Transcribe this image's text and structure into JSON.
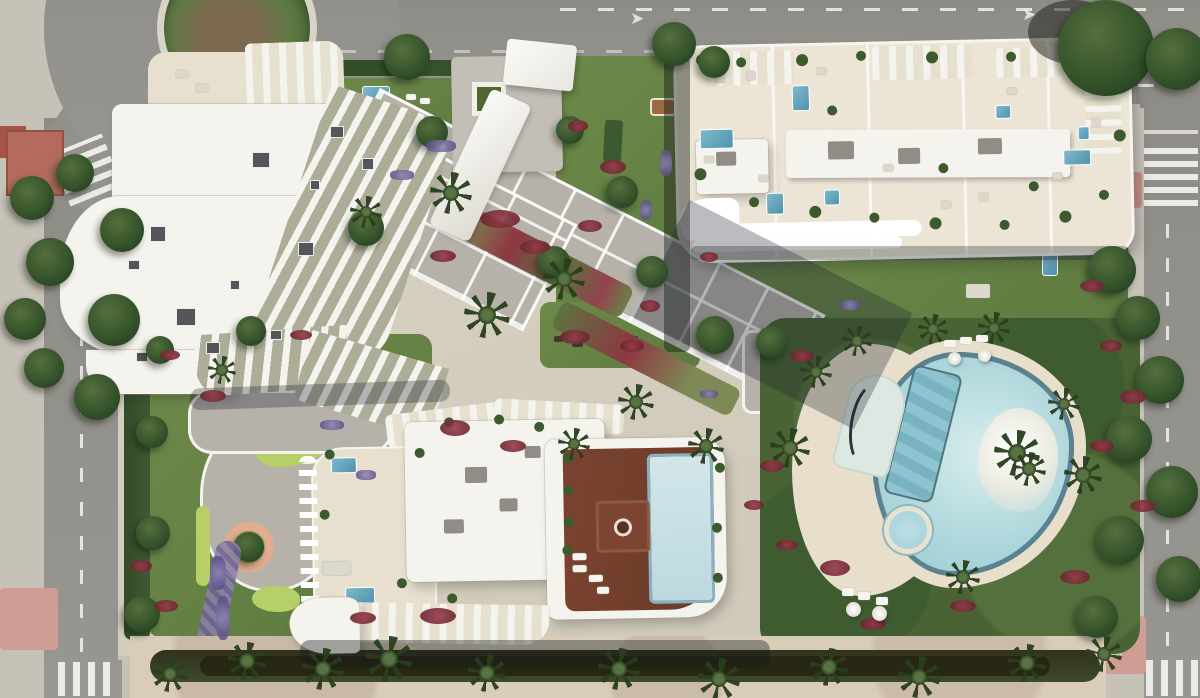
{
  "meta": {
    "title": "Aerial render of a residential resort block",
    "description": "Top-down architectural rendering: three white apartment buildings with roof terraces and plunge pools, central landscaped gardens with mini-golf, a lagoon-style pool with palm island, perimeter roads with a roundabout, zebra crossings and a beach promenade along the bottom.",
    "width": 1200,
    "height": 698
  },
  "palette": {
    "asphalt": "#8e8c87",
    "asphalt2": "#989690",
    "roadline": "#f2f2ee",
    "sidewalk": "#c7c2b8",
    "sidewalk2": "#b9b5ad",
    "pink": "#cf9d94",
    "lawn": "#6d8a49",
    "lawn2": "#5d7a40",
    "minigolf": "#b7cf67",
    "hedge": "#324c29",
    "hedge2": "#3f5a32",
    "tree1": "#55703d",
    "tree2": "#33512a",
    "tree3": "#243d1e",
    "flower_red": "#96394a",
    "flower_purple": "#8d83b5",
    "plaza": "#b6b2aa",
    "bld_white": "#f5f3ed",
    "terrace": "#e7e0cf",
    "roof_cream": "#ece5d5",
    "deck1": "#7a4330",
    "deck2": "#6b3a29",
    "pool1": "#7fb9cc",
    "pool2": "#4f93ad",
    "lagoon": "#abd6da",
    "lagoon_edge": "#5b8290",
    "island": "#efece2",
    "sand": "#d9cdb9",
    "sand2": "#e7decb"
  },
  "roads": {
    "arrow_glyph": "➤"
  },
  "scene": {
    "trees": [
      {
        "x": 384,
        "y": 34,
        "s": 46
      },
      {
        "x": 652,
        "y": 22,
        "s": 44
      },
      {
        "x": 698,
        "y": 46,
        "s": 32
      },
      {
        "x": 1058,
        "y": 0,
        "s": 96
      },
      {
        "x": 1146,
        "y": 28,
        "s": 62
      },
      {
        "x": 100,
        "y": 208,
        "s": 44
      },
      {
        "x": 88,
        "y": 294,
        "s": 52
      },
      {
        "x": 74,
        "y": 374,
        "s": 46
      },
      {
        "x": 10,
        "y": 176,
        "s": 44
      },
      {
        "x": 26,
        "y": 238,
        "s": 48
      },
      {
        "x": 4,
        "y": 298,
        "s": 42
      },
      {
        "x": 24,
        "y": 348,
        "s": 40
      },
      {
        "x": 348,
        "y": 210,
        "s": 36
      },
      {
        "x": 416,
        "y": 116,
        "s": 32
      },
      {
        "x": 556,
        "y": 116,
        "s": 28
      },
      {
        "x": 606,
        "y": 176,
        "s": 32
      },
      {
        "x": 636,
        "y": 256,
        "s": 32
      },
      {
        "x": 696,
        "y": 316,
        "s": 38
      },
      {
        "x": 756,
        "y": 326,
        "s": 32
      },
      {
        "x": 1088,
        "y": 246,
        "s": 48
      },
      {
        "x": 1116,
        "y": 296,
        "s": 44
      },
      {
        "x": 1136,
        "y": 356,
        "s": 48
      },
      {
        "x": 1106,
        "y": 416,
        "s": 46
      },
      {
        "x": 1146,
        "y": 466,
        "s": 52
      },
      {
        "x": 1096,
        "y": 516,
        "s": 48
      },
      {
        "x": 1156,
        "y": 556,
        "s": 46
      },
      {
        "x": 1076,
        "y": 596,
        "s": 42
      },
      {
        "x": 146,
        "y": 336,
        "s": 28
      },
      {
        "x": 136,
        "y": 416,
        "s": 32
      },
      {
        "x": 136,
        "y": 516,
        "s": 34
      },
      {
        "x": 124,
        "y": 596,
        "s": 36
      },
      {
        "x": 56,
        "y": 154,
        "s": 38
      },
      {
        "x": 538,
        "y": 246,
        "s": 32
      },
      {
        "x": 236,
        "y": 316,
        "s": 30
      }
    ],
    "palms": [
      {
        "x": 430,
        "y": 172,
        "s": 42
      },
      {
        "x": 464,
        "y": 292,
        "s": 46
      },
      {
        "x": 543,
        "y": 258,
        "s": 42
      },
      {
        "x": 618,
        "y": 384,
        "s": 36
      },
      {
        "x": 688,
        "y": 428,
        "s": 36
      },
      {
        "x": 558,
        "y": 428,
        "s": 32
      },
      {
        "x": 770,
        "y": 428,
        "s": 40
      },
      {
        "x": 800,
        "y": 356,
        "s": 32
      },
      {
        "x": 842,
        "y": 326,
        "s": 30
      },
      {
        "x": 918,
        "y": 314,
        "s": 30
      },
      {
        "x": 978,
        "y": 312,
        "s": 32
      },
      {
        "x": 1048,
        "y": 388,
        "s": 32
      },
      {
        "x": 1064,
        "y": 456,
        "s": 38
      },
      {
        "x": 946,
        "y": 560,
        "s": 34
      },
      {
        "x": 994,
        "y": 430,
        "s": 46
      },
      {
        "x": 1012,
        "y": 452,
        "s": 34
      },
      {
        "x": 350,
        "y": 196,
        "s": 32
      },
      {
        "x": 208,
        "y": 356,
        "s": 28
      },
      {
        "x": 302,
        "y": 648,
        "s": 42
      },
      {
        "x": 366,
        "y": 636,
        "s": 46
      },
      {
        "x": 468,
        "y": 654,
        "s": 38
      },
      {
        "x": 598,
        "y": 648,
        "s": 42
      },
      {
        "x": 698,
        "y": 658,
        "s": 42
      },
      {
        "x": 810,
        "y": 648,
        "s": 38
      },
      {
        "x": 898,
        "y": 656,
        "s": 42
      },
      {
        "x": 1008,
        "y": 644,
        "s": 38
      },
      {
        "x": 1086,
        "y": 636,
        "s": 36
      },
      {
        "x": 152,
        "y": 656,
        "s": 36
      },
      {
        "x": 228,
        "y": 642,
        "s": 38
      }
    ],
    "flowers_red": [
      {
        "x": 568,
        "y": 120,
        "w": 20,
        "h": 12
      },
      {
        "x": 600,
        "y": 160,
        "w": 26,
        "h": 14
      },
      {
        "x": 578,
        "y": 220,
        "w": 24,
        "h": 12
      },
      {
        "x": 640,
        "y": 300,
        "w": 20,
        "h": 12
      },
      {
        "x": 700,
        "y": 252,
        "w": 18,
        "h": 10
      },
      {
        "x": 480,
        "y": 210,
        "w": 40,
        "h": 18
      },
      {
        "x": 520,
        "y": 240,
        "w": 30,
        "h": 14
      },
      {
        "x": 430,
        "y": 250,
        "w": 26,
        "h": 12
      },
      {
        "x": 560,
        "y": 330,
        "w": 30,
        "h": 14
      },
      {
        "x": 620,
        "y": 340,
        "w": 24,
        "h": 12
      },
      {
        "x": 160,
        "y": 350,
        "w": 20,
        "h": 10
      },
      {
        "x": 200,
        "y": 390,
        "w": 26,
        "h": 12
      },
      {
        "x": 440,
        "y": 420,
        "w": 30,
        "h": 16
      },
      {
        "x": 500,
        "y": 440,
        "w": 26,
        "h": 12
      },
      {
        "x": 420,
        "y": 608,
        "w": 36,
        "h": 16
      },
      {
        "x": 350,
        "y": 612,
        "w": 26,
        "h": 12
      },
      {
        "x": 290,
        "y": 330,
        "w": 22,
        "h": 10
      },
      {
        "x": 790,
        "y": 350,
        "w": 24,
        "h": 12
      },
      {
        "x": 820,
        "y": 560,
        "w": 30,
        "h": 16
      },
      {
        "x": 860,
        "y": 618,
        "w": 26,
        "h": 12
      },
      {
        "x": 1080,
        "y": 280,
        "w": 24,
        "h": 12
      },
      {
        "x": 1100,
        "y": 340,
        "w": 22,
        "h": 12
      },
      {
        "x": 1120,
        "y": 390,
        "w": 26,
        "h": 14
      },
      {
        "x": 1090,
        "y": 440,
        "w": 24,
        "h": 12
      },
      {
        "x": 1130,
        "y": 500,
        "w": 26,
        "h": 12
      },
      {
        "x": 1060,
        "y": 570,
        "w": 30,
        "h": 14
      },
      {
        "x": 950,
        "y": 600,
        "w": 26,
        "h": 12
      },
      {
        "x": 760,
        "y": 460,
        "w": 24,
        "h": 12
      },
      {
        "x": 744,
        "y": 500,
        "w": 20,
        "h": 10
      },
      {
        "x": 776,
        "y": 540,
        "w": 22,
        "h": 10
      },
      {
        "x": 130,
        "y": 560,
        "w": 22,
        "h": 12
      },
      {
        "x": 154,
        "y": 600,
        "w": 24,
        "h": 12
      }
    ],
    "flowers_purple": [
      {
        "x": 320,
        "y": 420,
        "w": 24,
        "h": 10
      },
      {
        "x": 356,
        "y": 470,
        "w": 20,
        "h": 10
      },
      {
        "x": 210,
        "y": 556,
        "w": 16,
        "h": 34
      },
      {
        "x": 216,
        "y": 596,
        "w": 14,
        "h": 44
      },
      {
        "x": 660,
        "y": 150,
        "w": 12,
        "h": 26
      },
      {
        "x": 640,
        "y": 200,
        "w": 12,
        "h": 20
      },
      {
        "x": 426,
        "y": 140,
        "w": 30,
        "h": 12
      },
      {
        "x": 390,
        "y": 170,
        "w": 24,
        "h": 10
      },
      {
        "x": 840,
        "y": 300,
        "w": 20,
        "h": 10
      },
      {
        "x": 700,
        "y": 390,
        "w": 18,
        "h": 8
      }
    ],
    "b1_vents": [
      {
        "x": 150,
        "y": 226,
        "w": 16,
        "h": 16
      },
      {
        "x": 176,
        "y": 308,
        "w": 20,
        "h": 18
      },
      {
        "x": 252,
        "y": 152,
        "w": 18,
        "h": 16
      },
      {
        "x": 298,
        "y": 242,
        "w": 16,
        "h": 14
      },
      {
        "x": 330,
        "y": 126,
        "w": 14,
        "h": 12
      },
      {
        "x": 206,
        "y": 342,
        "w": 14,
        "h": 12
      },
      {
        "x": 136,
        "y": 352,
        "w": 12,
        "h": 10
      },
      {
        "x": 362,
        "y": 158,
        "w": 12,
        "h": 12
      },
      {
        "x": 128,
        "y": 260,
        "w": 12,
        "h": 10
      },
      {
        "x": 230,
        "y": 280,
        "w": 10,
        "h": 10
      },
      {
        "x": 310,
        "y": 180,
        "w": 10,
        "h": 10
      },
      {
        "x": 270,
        "y": 330,
        "w": 12,
        "h": 10
      }
    ],
    "b2_pools": [
      {
        "x": 115,
        "y": 39,
        "w": 18,
        "h": 26
      },
      {
        "x": 22,
        "y": 81,
        "w": 34,
        "h": 20
      },
      {
        "x": 87,
        "y": 146,
        "w": 18,
        "h": 22
      },
      {
        "x": 145,
        "y": 144,
        "w": 16,
        "h": 16
      },
      {
        "x": 318,
        "y": 63,
        "w": 16,
        "h": 14
      },
      {
        "x": 400,
        "y": 86,
        "w": 12,
        "h": 14
      },
      {
        "x": 385,
        "y": 109,
        "w": 28,
        "h": 16
      }
    ],
    "b2_plants": [
      {
        "x": 20,
        "y": 6,
        "s": 12
      },
      {
        "x": 60,
        "y": 10,
        "s": 10
      },
      {
        "x": 120,
        "y": 8,
        "s": 12
      },
      {
        "x": 180,
        "y": 6,
        "s": 10
      },
      {
        "x": 250,
        "y": 8,
        "s": 12
      },
      {
        "x": 330,
        "y": 10,
        "s": 10
      },
      {
        "x": 390,
        "y": 12,
        "s": 12
      },
      {
        "x": 430,
        "y": 40,
        "s": 10
      },
      {
        "x": 436,
        "y": 90,
        "s": 12
      },
      {
        "x": 420,
        "y": 150,
        "s": 10
      },
      {
        "x": 380,
        "y": 170,
        "s": 12
      },
      {
        "x": 320,
        "y": 178,
        "s": 10
      },
      {
        "x": 250,
        "y": 174,
        "s": 12
      },
      {
        "x": 190,
        "y": 168,
        "s": 10
      },
      {
        "x": 130,
        "y": 160,
        "s": 12
      },
      {
        "x": 70,
        "y": 150,
        "s": 10
      },
      {
        "x": 16,
        "y": 120,
        "s": 12
      },
      {
        "x": 150,
        "y": 60,
        "s": 10
      },
      {
        "x": 260,
        "y": 120,
        "s": 10
      },
      {
        "x": 350,
        "y": 140,
        "s": 10
      }
    ],
    "b2_furniture": [
      {
        "x": 38,
        "y": 28,
        "w": 10,
        "h": 7
      },
      {
        "x": 140,
        "y": 22,
        "w": 10,
        "h": 7
      },
      {
        "x": 205,
        "y": 120,
        "w": 10,
        "h": 7
      },
      {
        "x": 262,
        "y": 158,
        "w": 10,
        "h": 7
      },
      {
        "x": 330,
        "y": 46,
        "w": 10,
        "h": 7
      },
      {
        "x": 374,
        "y": 132,
        "w": 10,
        "h": 7
      },
      {
        "x": 80,
        "y": 128,
        "w": 10,
        "h": 7
      },
      {
        "x": 26,
        "y": 108,
        "w": 10,
        "h": 7
      },
      {
        "x": 414,
        "y": 78,
        "w": 9,
        "h": 9
      },
      {
        "x": 70,
        "y": 24,
        "w": 9,
        "h": 9
      },
      {
        "x": 300,
        "y": 150,
        "w": 9,
        "h": 9
      }
    ],
    "b3_plants": [
      {
        "x": 268,
        "y": 48,
        "s": 10
      },
      {
        "x": 268,
        "y": 80,
        "s": 10
      },
      {
        "x": 268,
        "y": 112,
        "s": 10
      },
      {
        "x": 266,
        "y": 140,
        "s": 10
      },
      {
        "x": 150,
        "y": 10,
        "s": 10
      },
      {
        "x": 200,
        "y": 8,
        "s": 10
      },
      {
        "x": 240,
        "y": 16,
        "s": 10
      },
      {
        "x": 120,
        "y": 40,
        "s": 10
      },
      {
        "x": 30,
        "y": 40,
        "s": 10
      },
      {
        "x": 24,
        "y": 100,
        "s": 10
      },
      {
        "x": 100,
        "y": 170,
        "s": 10
      },
      {
        "x": 150,
        "y": 186,
        "s": 10
      },
      {
        "x": 420,
        "y": 60,
        "s": 10
      },
      {
        "x": 416,
        "y": 120,
        "s": 10
      },
      {
        "x": 416,
        "y": 170,
        "s": 10
      }
    ],
    "b3_loungers": [
      {
        "x": 276,
        "y": 148,
        "w": 14,
        "h": 7
      },
      {
        "x": 276,
        "y": 160,
        "w": 14,
        "h": 7
      },
      {
        "x": 292,
        "y": 170,
        "w": 14,
        "h": 7
      },
      {
        "x": 300,
        "y": 182,
        "w": 12,
        "h": 7
      }
    ],
    "b3_boxes": [
      {
        "x": 170,
        "y": 60,
        "w": 22,
        "h": 16
      },
      {
        "x": 204,
        "y": 92,
        "w": 18,
        "h": 13
      },
      {
        "x": 148,
        "y": 112,
        "w": 20,
        "h": 14
      },
      {
        "x": 230,
        "y": 40,
        "w": 16,
        "h": 12
      }
    ],
    "lagoon_loungers": [
      {
        "x": 944,
        "y": 340,
        "w": 12,
        "h": 7
      },
      {
        "x": 960,
        "y": 337,
        "w": 12,
        "h": 7
      },
      {
        "x": 976,
        "y": 335,
        "w": 12,
        "h": 7
      },
      {
        "x": 842,
        "y": 588,
        "w": 12,
        "h": 8
      },
      {
        "x": 858,
        "y": 592,
        "w": 12,
        "h": 8
      },
      {
        "x": 876,
        "y": 597,
        "w": 12,
        "h": 8
      }
    ],
    "umbrellas": [
      {
        "x": 948,
        "y": 352,
        "s": 13
      },
      {
        "x": 978,
        "y": 349,
        "s": 13
      },
      {
        "x": 846,
        "y": 602,
        "s": 15
      },
      {
        "x": 872,
        "y": 606,
        "s": 15
      }
    ],
    "fitness_items": [
      {
        "x": 554,
        "y": 336,
        "w": 9,
        "h": 6
      },
      {
        "x": 572,
        "y": 341,
        "w": 11,
        "h": 6
      },
      {
        "x": 592,
        "y": 335,
        "w": 9,
        "h": 6
      },
      {
        "x": 610,
        "y": 341,
        "w": 13,
        "h": 6
      },
      {
        "x": 630,
        "y": 336,
        "w": 8,
        "h": 6
      }
    ]
  }
}
